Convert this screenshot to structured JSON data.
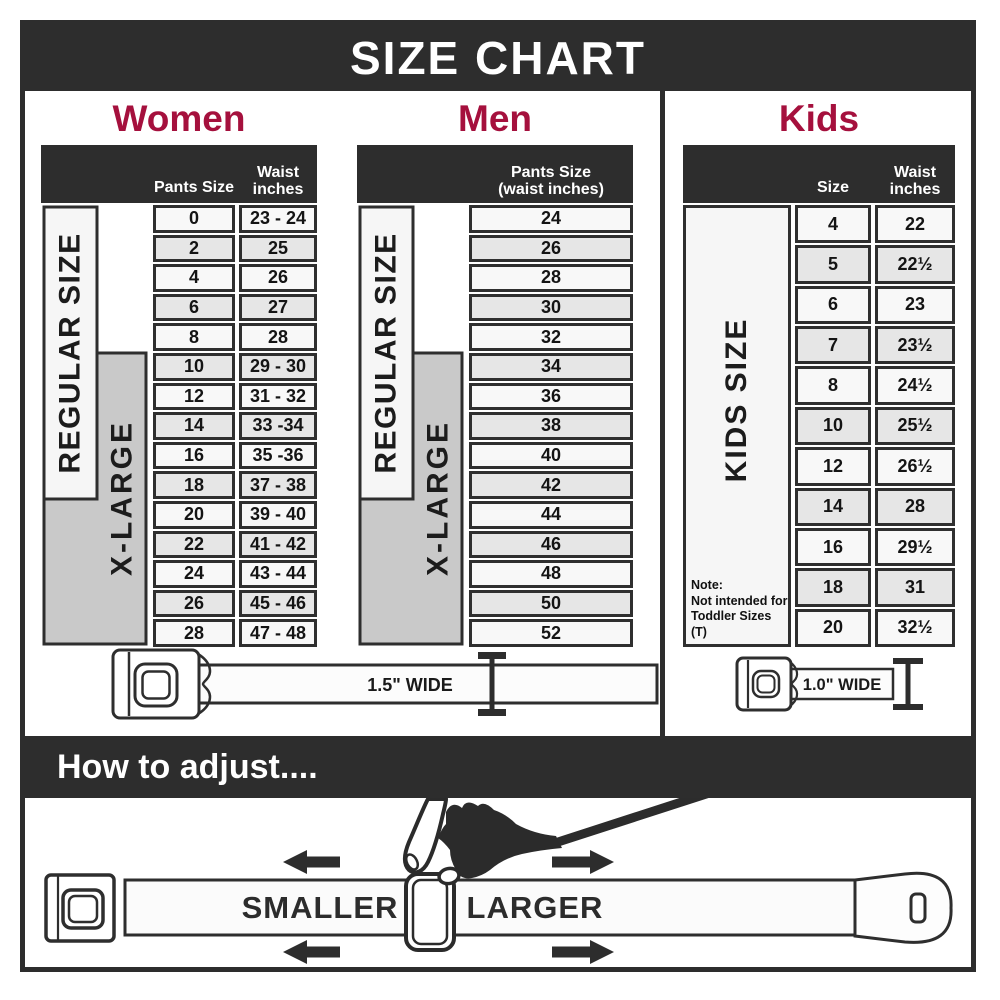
{
  "size_chart_title": "SIZE CHART",
  "colors": {
    "bar_dark": "#2d2d2d",
    "accent_red": "#a5103d",
    "xlarge_gray": "#c9c9c9",
    "row_light": "#f8f8f8",
    "row_shaded": "#e6e6e6",
    "cell_border": "#2f2f2f"
  },
  "women": {
    "title": "Women",
    "headers": {
      "col1": "Pants Size",
      "col2a": "Waist",
      "col2b": "inches"
    },
    "regular_label": "REGULAR SIZE",
    "xlarge_label": "X-LARGE",
    "rows": [
      {
        "size": "0",
        "waist": "23 - 24"
      },
      {
        "size": "2",
        "waist": "25"
      },
      {
        "size": "4",
        "waist": "26"
      },
      {
        "size": "6",
        "waist": "27"
      },
      {
        "size": "8",
        "waist": "28"
      },
      {
        "size": "10",
        "waist": "29 - 30"
      },
      {
        "size": "12",
        "waist": "31 - 32"
      },
      {
        "size": "14",
        "waist": "33 -34"
      },
      {
        "size": "16",
        "waist": "35 -36"
      },
      {
        "size": "18",
        "waist": "37 - 38"
      },
      {
        "size": "20",
        "waist": "39 - 40"
      },
      {
        "size": "22",
        "waist": "41 - 42"
      },
      {
        "size": "24",
        "waist": "43 - 44"
      },
      {
        "size": "26",
        "waist": "45 - 46"
      },
      {
        "size": "28",
        "waist": "47 - 48"
      }
    ]
  },
  "men": {
    "title": "Men",
    "headers": {
      "line1": "Pants Size",
      "line2": "(waist inches)"
    },
    "regular_label": "REGULAR SIZE",
    "xlarge_label": "X-LARGE",
    "rows": [
      "24",
      "26",
      "28",
      "30",
      "32",
      "34",
      "36",
      "38",
      "40",
      "42",
      "44",
      "46",
      "48",
      "50",
      "52"
    ]
  },
  "kids": {
    "title": "Kids",
    "headers": {
      "col1": "Size",
      "col2a": "Waist",
      "col2b": "inches"
    },
    "side_label": "KIDS SIZE",
    "note": {
      "title": "Note:",
      "line1": "Not intended for",
      "line2": "Toddler Sizes (T)"
    },
    "rows": [
      {
        "size": "4",
        "waist": "22"
      },
      {
        "size": "5",
        "waist": "22½"
      },
      {
        "size": "6",
        "waist": "23"
      },
      {
        "size": "7",
        "waist": "23½"
      },
      {
        "size": "8",
        "waist": "24½"
      },
      {
        "size": "10",
        "waist": "25½"
      },
      {
        "size": "12",
        "waist": "26½"
      },
      {
        "size": "14",
        "waist": "28"
      },
      {
        "size": "16",
        "waist": "29½"
      },
      {
        "size": "18",
        "waist": "31"
      },
      {
        "size": "20",
        "waist": "32½"
      }
    ]
  },
  "belts": {
    "adult_label": "1.5\" WIDE",
    "kids_label": "1.0\" WIDE"
  },
  "how_to": {
    "title": "How to adjust....",
    "smaller": "SMALLER",
    "larger": "LARGER"
  }
}
